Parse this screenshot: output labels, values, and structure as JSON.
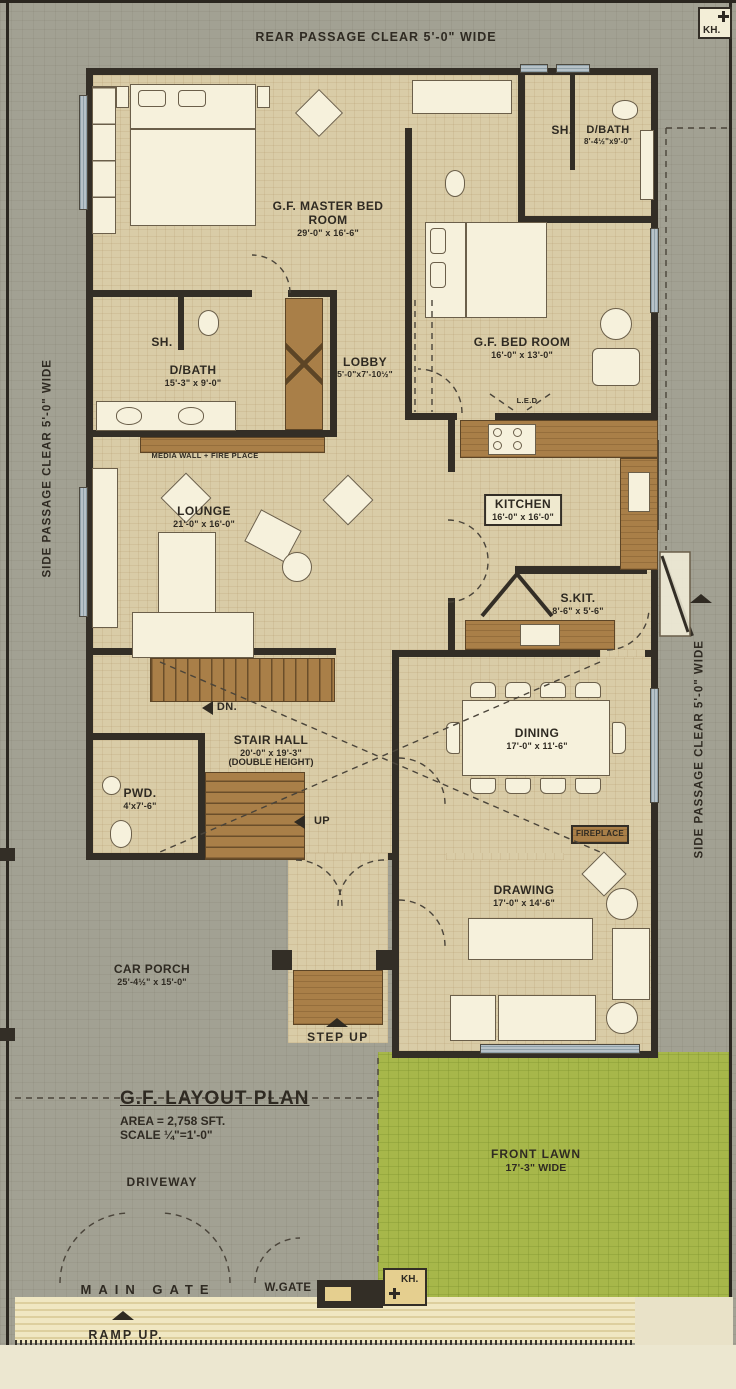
{
  "colors": {
    "wall": "#332e26",
    "floor": "#d9cca7",
    "outside": "#a2a193",
    "lawn": "#a7b74a",
    "wood": "#a97f48",
    "text": "#2f2a22"
  },
  "passages": {
    "rear": "REAR PASSAGE CLEAR 5'-0\" WIDE",
    "side_left": "SIDE PASSAGE CLEAR 5'-0\" WIDE",
    "side_right": "SIDE PASSAGE CLEAR 5'-0\" WIDE"
  },
  "kh_top": "KH.",
  "kh_bottom": "KH.",
  "rooms": {
    "master_bed": {
      "name": "G.F. MASTER BED ROOM",
      "dims": "29'-0\" x 16'-6\""
    },
    "sh_top": {
      "name": "SH."
    },
    "dbath_top": {
      "name": "D/BATH",
      "dims": "8'-4½\"x9'-0\""
    },
    "bed_room": {
      "name": "G.F. BED ROOM",
      "dims": "16'-0\" x 13'-0\""
    },
    "lobby": {
      "name": "LOBBY",
      "dims": "5'-0\"x7'-10½\""
    },
    "sh_left": {
      "name": "SH."
    },
    "dbath_left": {
      "name": "D/BATH",
      "dims": "15'-3\" x 9'-0\""
    },
    "lounge": {
      "name": "LOUNGE",
      "dims": "21'-0\" x 16'-0\""
    },
    "kitchen": {
      "name": "KITCHEN",
      "dims": "16'-0\" x 16'-0\""
    },
    "skit": {
      "name": "S.KIT.",
      "dims": "8'-6\" x 5'-6\""
    },
    "stair_hall": {
      "name": "STAIR HALL",
      "dims": "20'-0\" x 19'-3\"",
      "note": "(DOUBLE HEIGHT)"
    },
    "pwd": {
      "name": "PWD.",
      "dims": "4'x7'-6\""
    },
    "dining": {
      "name": "DINING",
      "dims": "17'-0\" x 11'-6\""
    },
    "drawing": {
      "name": "DRAWING",
      "dims": "17'-0\" x 14'-6\""
    },
    "car_porch": {
      "name": "CAR PORCH",
      "dims": "25'-4½\" x 15'-0\""
    }
  },
  "annotations": {
    "media_wall": "MEDIA WALL + FIRE PLACE",
    "led": "L.E.D",
    "dn": "DN.",
    "up": "UP",
    "fireplace": "FIREPLACE",
    "step_up": "STEP UP"
  },
  "title_block": {
    "title": "G.F. LAYOUT PLAN",
    "area": "AREA = 2,758 SFT.",
    "scale": "SCALE ¼\"=1'-0\""
  },
  "outdoor": {
    "driveway": "DRIVEWAY",
    "front_lawn": "FRONT LAWN",
    "front_lawn_dims": "17'-3\" WIDE",
    "main_gate": "MAIN GATE",
    "w_gate": "W.GATE",
    "ramp_up": "RAMP UP."
  }
}
